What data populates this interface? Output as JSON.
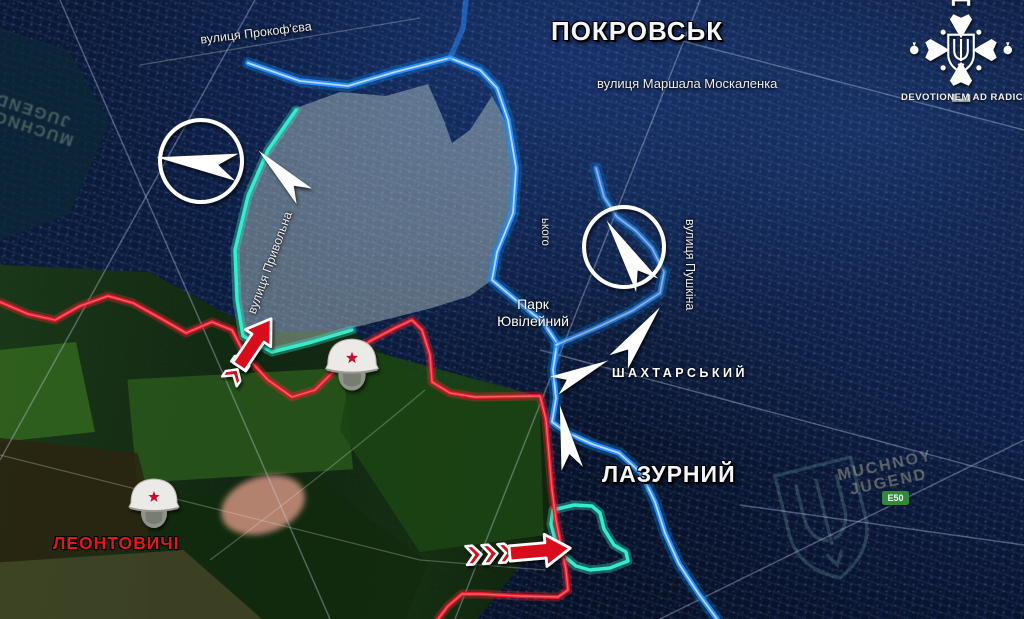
{
  "labels": {
    "city": "ПОКРОВСЬК",
    "district_lazurnyi": "ЛАЗУРНИЙ",
    "district_shakhtarskyi": "ШАХТАРСЬКИЙ",
    "village_leontovychi": "ЛЕОНТОВИЧІ",
    "park_line1": "Парк",
    "park_line2": "Ювілейний",
    "street_prokofieva": "вулиця Прокоф'єва",
    "street_moskalenka": "вулиця Маршала Москаленка",
    "street_pryvolna": "вулиця Привольна",
    "street_pushkina": "вулиця Пушкіна",
    "street_fragment": "ького"
  },
  "watermarks": {
    "left_line1": "MUCHNOY",
    "left_line2": "JUGEND",
    "right_line1": "MUCHNOY",
    "right_line2": "JUGEND"
  },
  "logo": {
    "motto": "DEVOTIONEM AD RADICES"
  },
  "road_badge": {
    "label": "E50"
  },
  "colors": {
    "russian_front_line": "#e8192c",
    "ukrainian_front_line": "#2e8bff",
    "contested_outline": "#35eccb",
    "attack_arrow": "#d8101e",
    "movement_arrow": "#ffffff",
    "map_background": "#081126"
  },
  "symbols": {
    "helmet": "soviet-helmet-icon",
    "attack_arrow": "red-attack-arrow",
    "movement_arrow": "white-movement-arrow",
    "movement_circle": "white-circle-marker",
    "tryzub": "ukraine-trident-watermark"
  }
}
